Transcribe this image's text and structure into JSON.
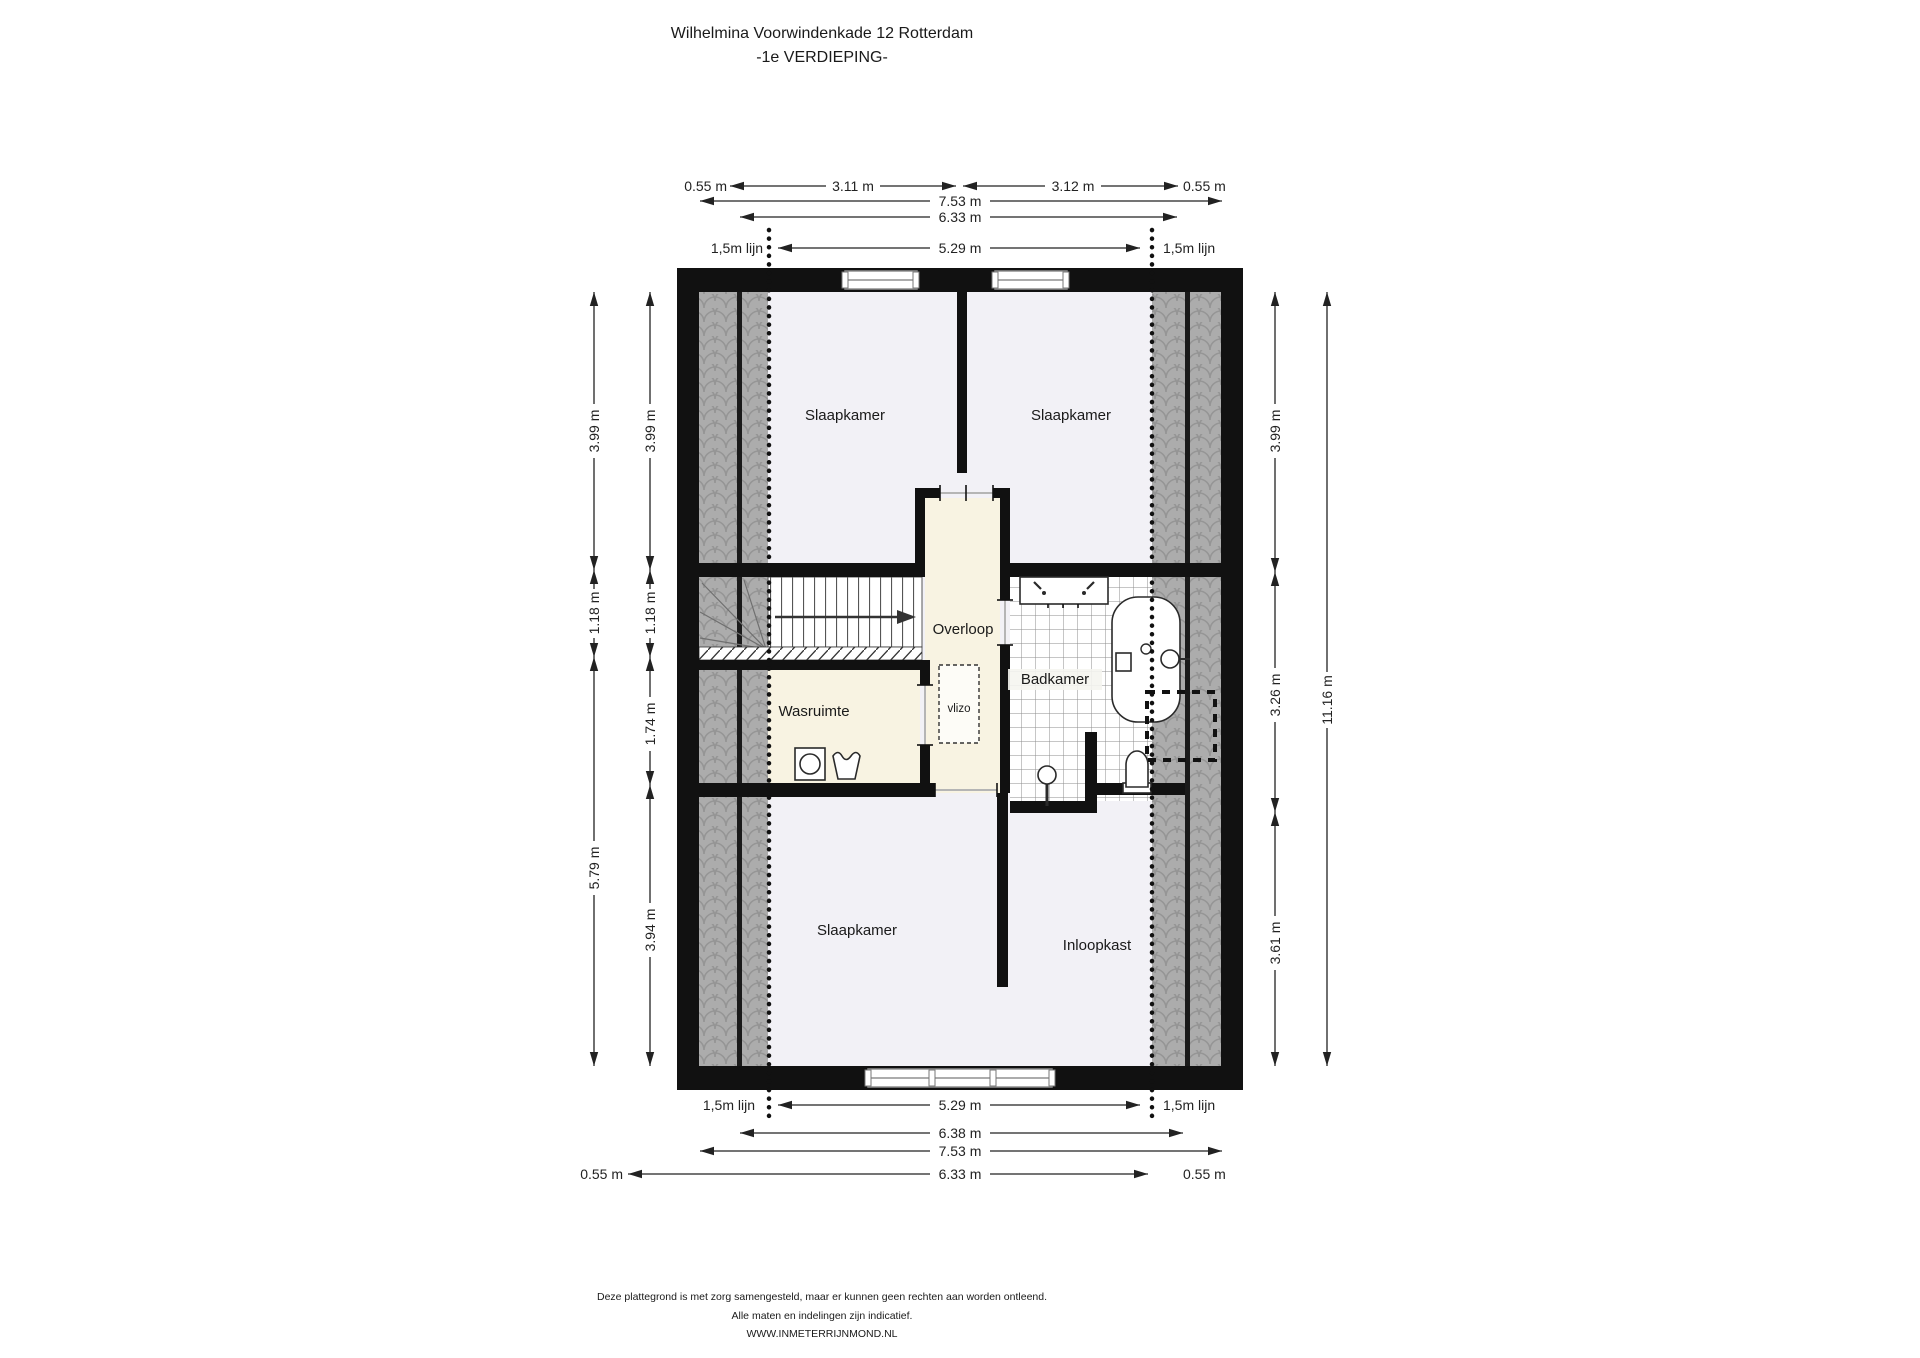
{
  "title": {
    "line1": "Wilhelmina Voorwindenkade 12 Rotterdam",
    "line2": "-1e VERDIEPING-"
  },
  "rooms": {
    "bedroom_top_left": "Slaapkamer",
    "bedroom_top_right": "Slaapkamer",
    "bedroom_bottom": "Slaapkamer",
    "landing": "Overloop",
    "laundry_room": "Wasruimte",
    "bathroom": "Badkamer",
    "walk_in_closet": "Inloopkast",
    "loft_ladder": "vlizo"
  },
  "dimensions": {
    "top": {
      "left_offset": "0.55 m",
      "segment_left": "3.11 m",
      "segment_right": "3.12 m",
      "right_offset": "0.55 m",
      "total_width": "7.53 m",
      "inner_width": "6.33 m",
      "line_left": "1,5m lijn",
      "line_width": "5.29 m",
      "line_right": "1,5m lijn"
    },
    "bottom": {
      "line_left": "1,5m lijn",
      "line_width": "5.29 m",
      "line_right": "1,5m lijn",
      "width_mid": "6.38 m",
      "total_width": "7.53 m",
      "left_offset": "0.55 m",
      "inner_width": "6.33 m",
      "right_offset": "0.55 m"
    },
    "left_outer": [
      "3.99 m",
      "1.18 m",
      "5.79 m"
    ],
    "left_inner": [
      "3.99 m",
      "1.18 m",
      "1.74 m",
      "3.94 m"
    ],
    "right_inner": [
      "3.99 m",
      "3.26 m",
      "3.61 m"
    ],
    "right_outer": [
      "11.16 m"
    ]
  },
  "footer": {
    "line1": "Deze plattegrond is met zorg samengesteld, maar er kunnen geen rechten aan worden ontleend.",
    "line2": "Alle maten en indelingen zijn indicatief.",
    "line3": "WWW.INMETERRIJNMOND.NL"
  },
  "colors": {
    "wall": "#111111",
    "floor": "#f2f1f6",
    "floor_warm": "#f8f3e2",
    "roof_band": "#acacac",
    "tile_line": "#8d8d8d",
    "dimension": "#222222",
    "text": "#1a1a1a"
  }
}
